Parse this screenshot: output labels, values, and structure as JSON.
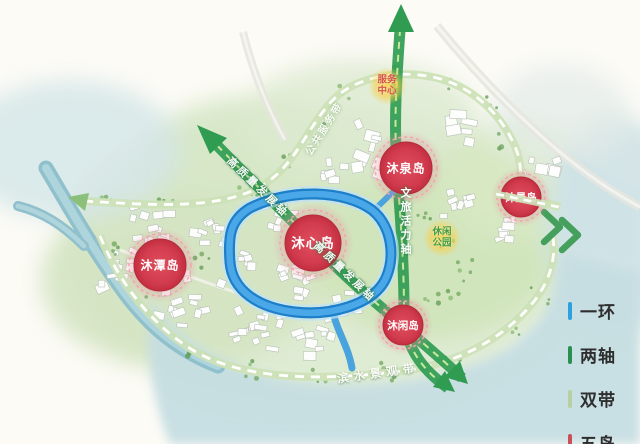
{
  "map": {
    "islands": [
      {
        "name": "沐心岛"
      },
      {
        "name": "沐泉岛"
      },
      {
        "name": "沐景岛"
      },
      {
        "name": "沐潭岛"
      },
      {
        "name": "沐闲岛"
      }
    ],
    "axes": {
      "vertical_label": "文旅活力轴",
      "diagonal_label": "高质量发展轴"
    },
    "belts": {
      "top_label": "公共服务带",
      "bottom_label": "滨水景观带"
    },
    "badges": [
      {
        "line1": "服务",
        "line2": "中心"
      },
      {
        "line1": "休闲",
        "line2": "公园"
      }
    ]
  },
  "legend": {
    "items": [
      {
        "label": "一环",
        "color": "#2da0dd"
      },
      {
        "label": "两轴",
        "color": "#2c8f52"
      },
      {
        "label": "双带",
        "color": "#b8cfa3"
      },
      {
        "label": "五岛",
        "color": "#c94f5a"
      }
    ]
  },
  "colors": {
    "ring_blue": "#3b9fe3",
    "axis_green": "#2f9c52",
    "belt_green": "#cde2b8",
    "island_red": "#d23c4e"
  }
}
